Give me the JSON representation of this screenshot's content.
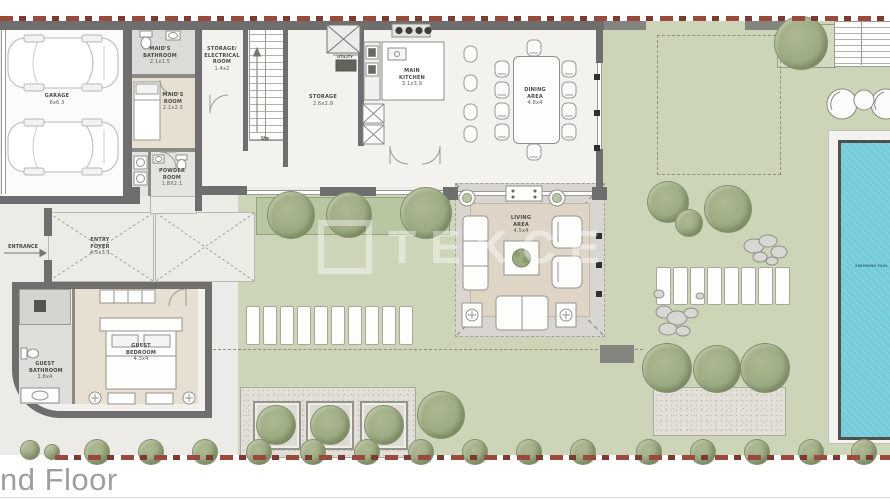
{
  "titles": {
    "floor_label": "nd Floor"
  },
  "branding": {
    "watermark": "TEKCE"
  },
  "annotations": {
    "entrance": "ENTRANCE",
    "up": "Up"
  },
  "rooms": {
    "garage": {
      "name": "GARAGE",
      "dims": "6x6.3"
    },
    "maids_bathroom": {
      "name": "MAID'S BATHROOM",
      "dims": "2.1x1.5"
    },
    "maids_room": {
      "name": "MAID'S ROOM",
      "dims": "2.1x2.5"
    },
    "storage_electrical": {
      "name": "STORAGE/ ELECTRICAL ROOM",
      "dims": "1.4x2"
    },
    "powder_room": {
      "name": "POWDER ROOM",
      "dims": "1.8X2.1"
    },
    "utility": {
      "name": "UTILITY"
    },
    "storage": {
      "name": "STORAGE",
      "dims": "2.6x2.9"
    },
    "main_kitchen": {
      "name": "MAIN KITCHEN",
      "dims": "3.1x3.9"
    },
    "dining_area": {
      "name": "DINING AREA",
      "dims": "4.8x4"
    },
    "living_area": {
      "name": "LIVING AREA",
      "dims": "4.5x4"
    },
    "entry_foyer": {
      "name": "ENTRY FOYER",
      "dims": "4.5x3.1"
    },
    "guest_bedroom": {
      "name": "GUEST BEDROOM",
      "dims": "4.3x4"
    },
    "guest_bathroom": {
      "name": "GUEST BATHROOM",
      "dims": "1.8x4"
    },
    "swimming_pool": {
      "name": "SWIMMING POOL"
    }
  },
  "colors": {
    "boundary": "#9a4a3c",
    "wall": "#6e6e6e",
    "lawn": "#ccd5b8",
    "pool_water": "#74cbd9",
    "bedroom_floor": "#e7dfd2",
    "tree": "#9cab81"
  }
}
